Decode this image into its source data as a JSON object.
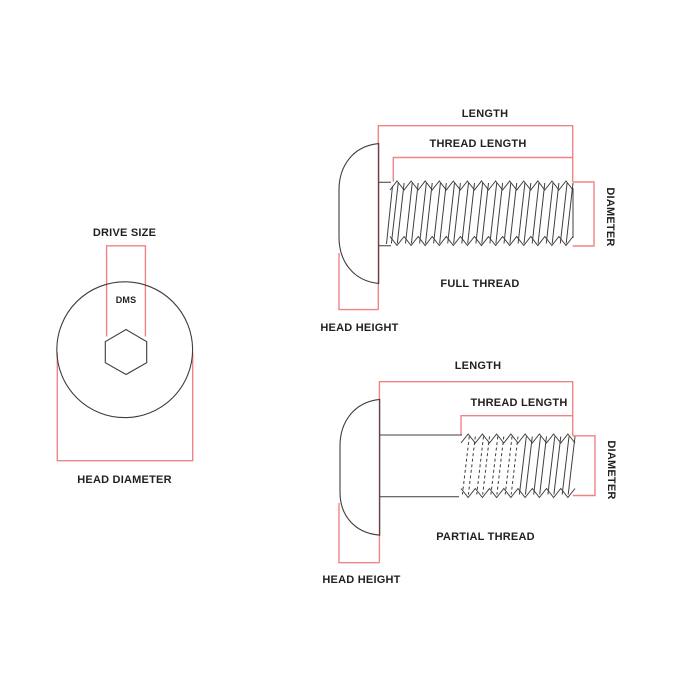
{
  "colors": {
    "dimension_red": "#ef8485",
    "outline_black": "#403c3d",
    "text": "#231f20",
    "background": "#ffffff"
  },
  "head_top_view": {
    "drive_size_label": "DRIVE SIZE",
    "drive_marking": "DMS",
    "head_diameter_label": "HEAD DIAMETER"
  },
  "full_thread_view": {
    "length_label": "LENGTH",
    "thread_length_label": "THREAD LENGTH",
    "diameter_label": "DIAMETER",
    "thread_type_label": "FULL THREAD",
    "head_height_label": "HEAD HEIGHT"
  },
  "partial_thread_view": {
    "length_label": "LENGTH",
    "thread_length_label": "THREAD LENGTH",
    "diameter_label": "DIAMETER",
    "thread_type_label": "PARTIAL THREAD",
    "head_height_label": "HEAD HEIGHT"
  }
}
